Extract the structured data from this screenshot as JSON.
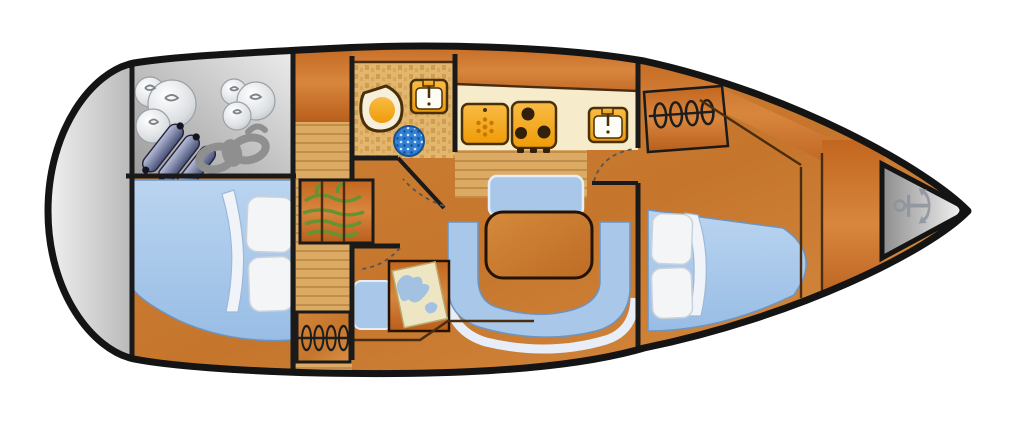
{
  "title": "sailboat-interior-floorplan",
  "palette": {
    "hull_outline": "#141414",
    "wall": "#1a1a1a",
    "panel_line": "#4a2c10",
    "counter_cream": "#f6ebcb",
    "upholstery_blue": "#a9c8e9",
    "upholstery_edge": "#6b94c4",
    "trim_white": "#e7eef7",
    "pillow_white": "#f3f5f7",
    "pillow_edge": "#c9d2da",
    "appliance_outline": "#4a3008",
    "burner_dark": "#33200a",
    "snowflake_orange": "#c87800",
    "toilet_cream": "#f6efdc",
    "shower_edge": "#1b4f8f",
    "map_paper": "#eee6c3",
    "map_sea": "#a3c2e2",
    "plant_green": "#679231",
    "rope_gray": "#8f8f8f",
    "fender_knob": "#15151f",
    "anchor_gray": "#8d929c",
    "door_arc": "#555555",
    "sheet_white": "#f0f4f8"
  },
  "icons": {
    "anchor_char": "⚓"
  },
  "legend": {
    "components": [
      "stern swim platform",
      "stern storage locker with round fenders, cylinder fenders and mooring ropes",
      "aft double berth cabin",
      "companionway steps",
      "aft hanging locker",
      "head with toilet, sink and shower seat",
      "galley with fridge, three-burner stove and sink",
      "salon with U-shaped settee and table",
      "navigation station with chart table and seat",
      "forward hanging locker",
      "forward V-berth cabin",
      "bow anchor locker"
    ]
  }
}
